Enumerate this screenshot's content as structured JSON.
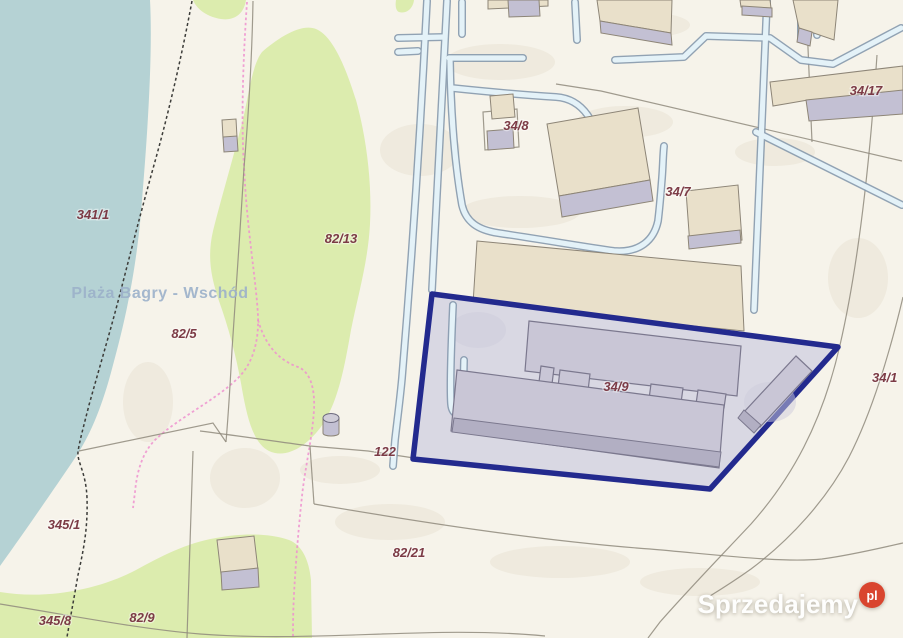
{
  "map": {
    "place_label": "Plaża Bagry - Wschód",
    "highlighted_parcel": "34/9",
    "parcel_labels": [
      {
        "text": "341/1"
      },
      {
        "text": "82/13"
      },
      {
        "text": "82/5"
      },
      {
        "text": "122"
      },
      {
        "text": "82/21"
      },
      {
        "text": "345/1"
      },
      {
        "text": "345/8"
      },
      {
        "text": "82/9"
      },
      {
        "text": "34/8"
      },
      {
        "text": "34/7"
      },
      {
        "text": "34/17"
      },
      {
        "text": "34/9"
      },
      {
        "text": "34/1"
      }
    ],
    "colors": {
      "cream": "#f6f3ea",
      "water": "#b5d2d4",
      "green": "#dcecae",
      "navy": "#232a8e",
      "parcelFill": "#d9d8e3",
      "buildingTan": "#e9e0ca",
      "buildingLavender": "#c3c0d3",
      "outlineTan": "#8d8577",
      "innerBuilding": "#c9c6d6",
      "innerBuildingDark": "#b2afc3",
      "outlineInner": "#7b788e",
      "utilityOuter": "#8095aa",
      "utilityInner": "#e4f2f8",
      "boundary": "#8f897c",
      "labelColor": "#7c3b46",
      "placeLabelColor": "#9cb1ca",
      "pathPink": "#ee90cf",
      "shoreDash": "#3c3c39",
      "terrainShade": "#e8e2d2",
      "parcelShade": "#cdccdc",
      "watermarkRed": "#d9452f"
    }
  },
  "watermark": {
    "brand": "Sprzedajemy",
    "tld": "pl"
  }
}
